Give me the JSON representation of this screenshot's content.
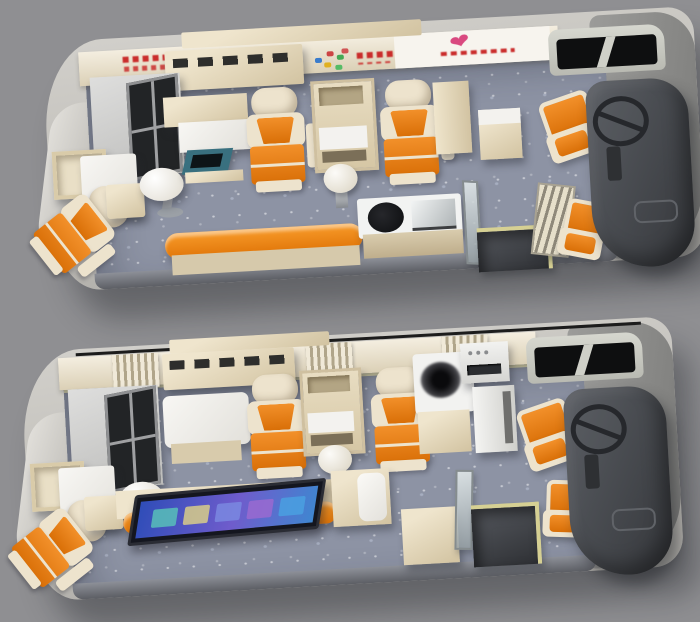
{
  "scene": {
    "description": "Two photoreal 3D cutaway top-down renders of a mobile blood-donation bus interior, upper and lower layout variants on a gray backdrop",
    "background": "#8f8f92",
    "glyphs": {
      "heart": "❤"
    },
    "colors": {
      "floor": "#8d93a4",
      "floor_dark": "#63666e",
      "trim": "#d6d093",
      "cream": "#efe5cd",
      "cream_dark": "#d2c3a1",
      "white": "#f4f4f1",
      "orange": "#f2902a",
      "orange_dark": "#d96f07",
      "seat_cream": "#ede3cd",
      "shell_light": "#d2d0cb",
      "shell_dark": "#9d9b96",
      "dashboard": "#44464b",
      "teal_screen": "#39707f",
      "glass_dark": "#222426",
      "slogan_red": "#c52727",
      "heart_pink": "#d9487f",
      "tv1": "#58c0b8",
      "tv2": "#d8cc88",
      "tv3": "#7a88e0",
      "tv4": "#9a6ad0",
      "tv5": "#4aa0e0"
    },
    "buses": [
      {
        "id": "top",
        "name": "Layout variant 1 (upper bus)",
        "features": [
          "glass-door storage cabinet",
          "open storage cubby",
          "white counter bed",
          "rear donor lounge chair",
          "pedestal table",
          "registration desk with recessed teal monitor",
          "donor chair left",
          "supply shelf unit",
          "round stool",
          "donor chair right",
          "tall storage cabinet",
          "side cabinet",
          "long orange service counter",
          "counter with induction hob and steel sink",
          "glass partition",
          "entry step well",
          "folding slat seat",
          "attendant seat",
          "driver seat",
          "dashboard with steering wheel",
          "front corner window",
          "red wall slogans",
          "colorful blood-center logo",
          "heart decal panel",
          "louvered overhead cabinet"
        ]
      },
      {
        "id": "bottom",
        "name": "Layout variant 2 (lower bus)",
        "features": [
          "glass-door storage cabinet",
          "open storage cubby",
          "white counter bed",
          "rear donor lounge chair",
          "pedestal table",
          "large white exam table",
          "donor chair left",
          "supply shelf unit",
          "round stool",
          "donor chair right",
          "device cabinet with centrifuge bowl",
          "bench with white cushion",
          "instrument with display panel",
          "tall white cabinet",
          "wall-mounted TV screen on orange rail",
          "step-well cabinet",
          "glass door panel",
          "entry step well",
          "attendant seat",
          "driver seat",
          "dashboard with steering wheel",
          "front corner window",
          "curtained window slats",
          "louvered overhead cabinet",
          "roof cut edge line"
        ]
      }
    ]
  }
}
